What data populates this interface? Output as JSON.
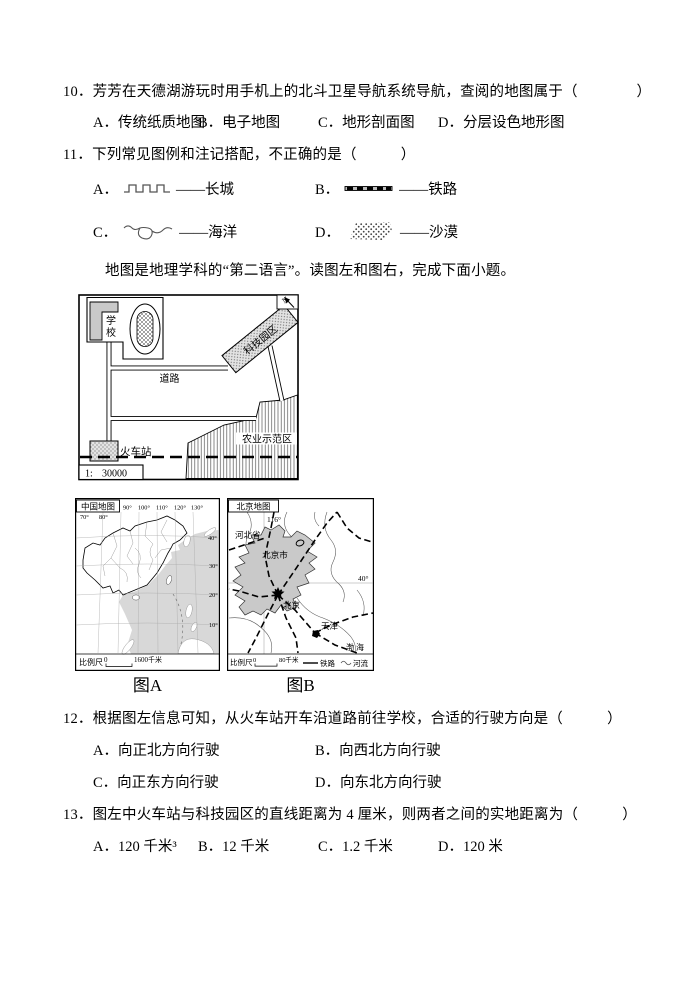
{
  "questions": [
    {
      "number": "10．",
      "stem": "芳芳在天德湖游玩时用手机上的北斗卫星导航系统导航，查阅的地图属于（　　　　）",
      "options": [
        {
          "label": "A．",
          "text": "传统纸质地图"
        },
        {
          "label": "B．",
          "text": "电子地图"
        },
        {
          "label": "C．",
          "text": "地形剖面图"
        },
        {
          "label": "D．",
          "text": "分层设色地形图"
        }
      ]
    },
    {
      "number": "11．",
      "stem": "下列常见图例和注记搭配，不正确的是（　　　）",
      "options": [
        {
          "label": "A．",
          "icon": "great-wall-symbol",
          "text": "——长城"
        },
        {
          "label": "B．",
          "icon": "railway-symbol",
          "text": "——铁路"
        },
        {
          "label": "C．",
          "icon": "ocean-symbol",
          "text": "——海洋"
        },
        {
          "label": "D．",
          "icon": "desert-symbol",
          "text": "——沙漠"
        }
      ]
    },
    {
      "number": "12．",
      "stem": "根据图左信息可知，从火车站开车沿道路前往学校，合适的行驶方向是（　　　）",
      "options": [
        {
          "label": "A．",
          "text": "向正北方向行驶"
        },
        {
          "label": "B．",
          "text": "向西北方向行驶"
        },
        {
          "label": "C．",
          "text": "向正东方向行驶"
        },
        {
          "label": "D．",
          "text": "向东北方向行驶"
        }
      ]
    },
    {
      "number": "13．",
      "stem": "图左中火车站与科技园区的直线距离为 4 厘米，则两者之间的实地距离为（　　　）",
      "options": [
        {
          "label": "A．",
          "text": "120 千米³"
        },
        {
          "label": "B．",
          "text": "12 千米"
        },
        {
          "label": "C．",
          "text": "1.2 千米"
        },
        {
          "label": "D．",
          "text": "120 米"
        }
      ]
    }
  ],
  "passage": "地图是地理学科的“第二语言”。读图左和图右，完成下面小题。",
  "sketch_map": {
    "north_label": "N",
    "school": "学校",
    "road": "道路",
    "tech_park": "科技园区",
    "agri_zone": "农业示范区",
    "train_station": "火车站",
    "scale_prefix": "1:",
    "scale_value": "30000"
  },
  "figure_a": {
    "title": "中国地图",
    "caption": "图A",
    "top_lon_labels": [
      "90°",
      "100°",
      "110°",
      "120°",
      "130°"
    ],
    "left_lon_labels": [
      "70°",
      "80°"
    ],
    "right_lat_labels": [
      "40°",
      "30°",
      "20°",
      "10°"
    ],
    "scale_label": "比例尺",
    "scale_zero": "0",
    "scale_text": "1600千米"
  },
  "figure_b": {
    "title": "北京地图",
    "caption": "图B",
    "lon_label": "116°",
    "lat_label": "40°",
    "hebei": "河北省",
    "beijing_city": "北京市",
    "beijing": "北京",
    "tianjin": "天津",
    "bohai": "渤 海",
    "scale_label": "比例尺",
    "scale_zero": "0",
    "scale_text": "80千米",
    "legend_railway": "铁路",
    "legend_river": "河流"
  }
}
